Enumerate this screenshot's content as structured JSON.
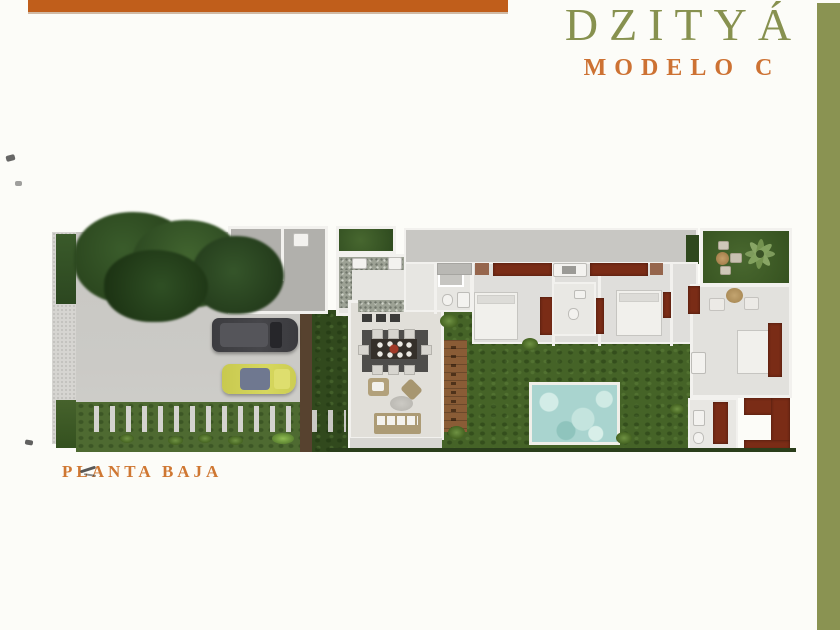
{
  "header": {
    "title": "DZITYÁ",
    "subtitle": "MODELO C",
    "title_color": "#87914f",
    "subtitle_color": "#cd7233",
    "top_bar_color": "#c05e1b",
    "side_bar_color": "#8a9352"
  },
  "caption": {
    "text": "PLANTA BAJA",
    "color": "#cf7732"
  },
  "plan": {
    "palette": {
      "sidewalk": "#d6d5d1",
      "driveway": "#cbcac6",
      "lawn": "#4e6a31",
      "garden": "#456327",
      "hedge": "#31491d",
      "wall": "#f2f1ee",
      "floor": "#e1dfd9",
      "utility": "#b1b0ac",
      "band": "#c8c7c3",
      "deck": "#8a5c36",
      "pool": "#a9d4cf",
      "accent": "#7a2c16",
      "suv": "#46464a",
      "car": "#d6d75e"
    }
  }
}
